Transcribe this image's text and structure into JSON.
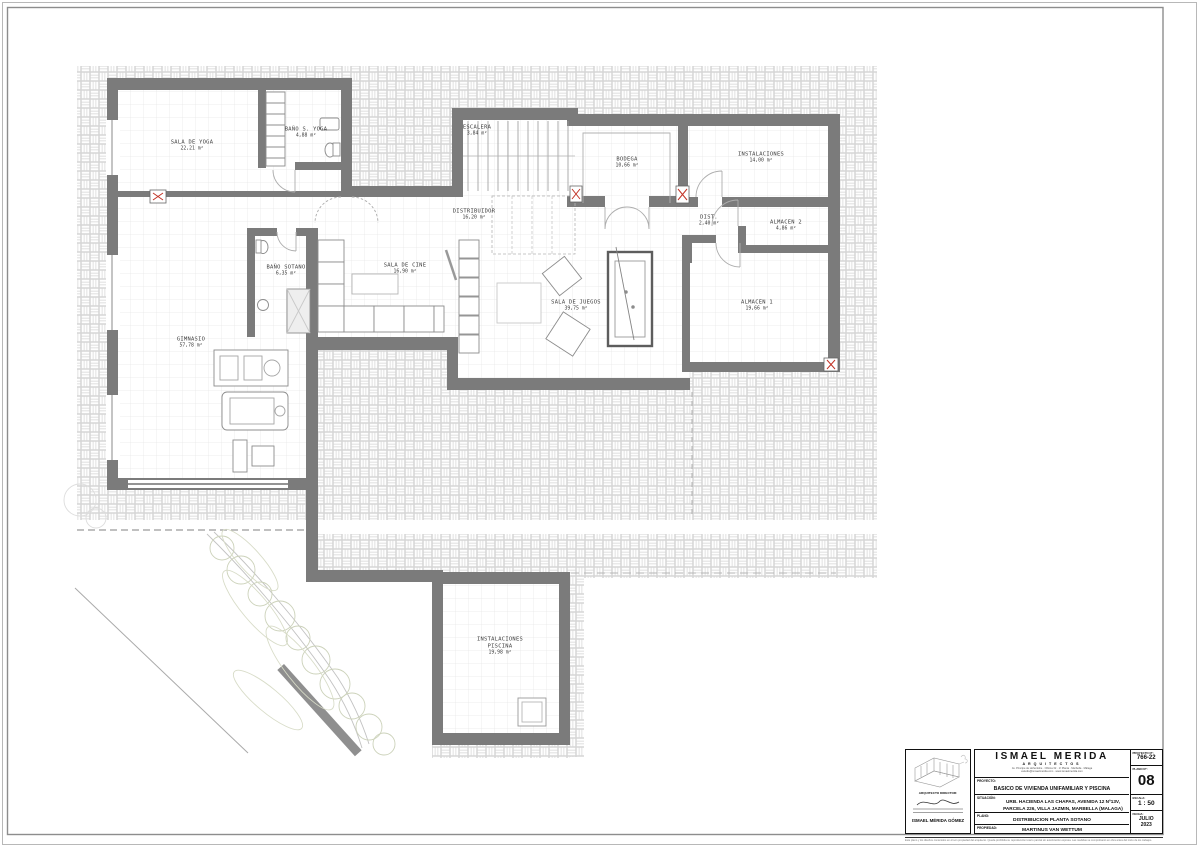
{
  "rooms": [
    {
      "name": "SALA DE YOGA",
      "area": "22,21 m²"
    },
    {
      "name": "BAÑO S. YOGA",
      "area": "4,88 m²"
    },
    {
      "name": "ESCALERA",
      "area": "3,84 m²"
    },
    {
      "name": "BODEGA",
      "area": "10,66 m²"
    },
    {
      "name": "INSTALACIONES",
      "area": "14,00 m²"
    },
    {
      "name": "DISTRIBUIDOR",
      "area": "16,20 m²"
    },
    {
      "name": "DIST.",
      "area": "2,40 m²"
    },
    {
      "name": "ALMACEN 2",
      "area": "4,86 m²"
    },
    {
      "name": "BAÑO SOTANO",
      "area": "6,35 m²"
    },
    {
      "name": "SALA DE CINE",
      "area": "16,90 m²"
    },
    {
      "name": "SALA DE JUEGOS",
      "area": "39,75 m²"
    },
    {
      "name": "ALMACEN 1",
      "area": "19,66 m²"
    },
    {
      "name": "GIMNASIO",
      "area": "57,78 m²"
    },
    {
      "name": "INSTALACIONES PISCINA",
      "area": "19,98 m²"
    }
  ],
  "title_block": {
    "firm_name": "ISMAEL MERIDA",
    "firm_subtitle": "ARQUITECTOS",
    "firm_address_line1": "Av. Principe de Hohenlohe · Oficina 32 · 1ª Planta · Marbella · Málaga",
    "firm_address_line2": "estudio@ismaelmerida.com · www.ismaelmerida.com",
    "architect_director_label": "ARQUITECTO DIRECTOR:",
    "architect_name": "ISMAEL MÉRIDA GÓMEZ",
    "proyecto_label": "PROYECTO:",
    "proyecto": "BASICO DE VIVIENDA UNIFAMILIAR Y PISCINA",
    "situacion_label": "SITUACIÓN:",
    "situacion_line1": "URB. HACIENDA LAS CHAPAS, AVENIDA 12 Nº13V,",
    "situacion_line2": "PARCELA 226, VILLA JAZMIN, MARBELLA (MALAGA)",
    "plano_label": "PLANO:",
    "plano": "DISTRIBUCION PLANTA SOTANO",
    "propiedad_label": "PROPIEDAD:",
    "propiedad": "MARTINUS VAN WETTUM",
    "proyecto_no_label": "PROYECTO Nº:",
    "proyecto_no": "766-22",
    "plano_no_label": "PLANO Nº:",
    "plano_no": "08",
    "escala_label": "ESCALA:",
    "escala": "1 : 50",
    "fecha_label": "FECHA:",
    "fecha_month": "JULIO",
    "fecha_year": "2023",
    "disclaimer": "Este plano y los diseños contenidos en él son propiedad del arquitecto. Queda prohibida su reproducción total o parcial sin autorización expresa. Las medidas se comprobarán en obra antes del inicio de los trabajos."
  },
  "colors": {
    "wall": "#7b7b7b",
    "hatch_line": "#d4d4d4",
    "grid_line": "#e7e7e7",
    "marker_red": "#c23326",
    "foliage": "#ccd2ba"
  }
}
